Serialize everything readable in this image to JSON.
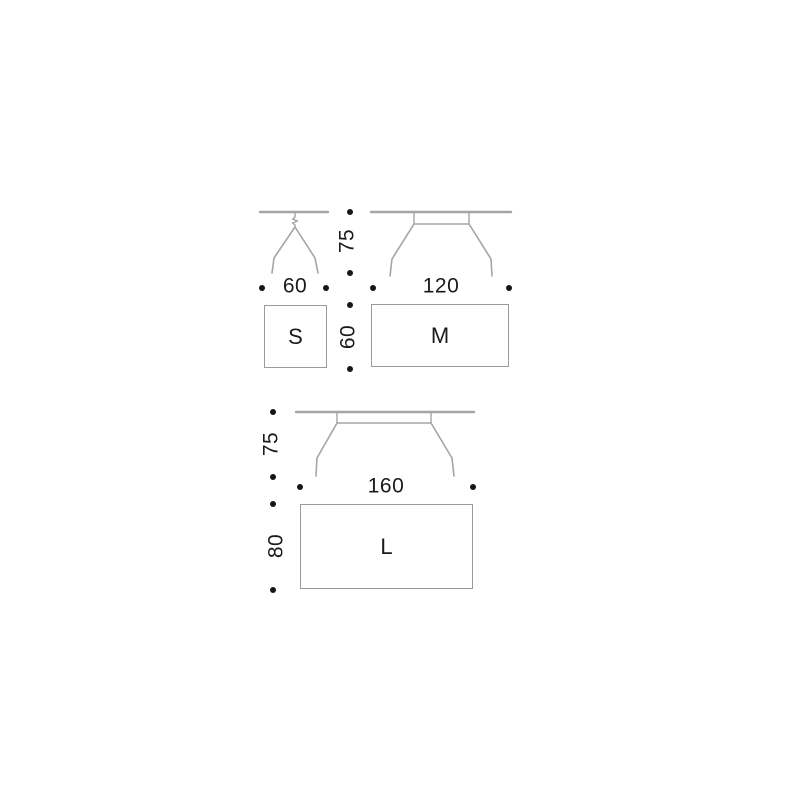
{
  "diagram": {
    "kind": "table-size-dimension-diagram",
    "units_shown": false,
    "colors": {
      "background": "#ffffff",
      "line_art": "#a5a5a5",
      "rect_border": "#9b9b9b",
      "text": "#1a1a1a",
      "dot": "#161616"
    },
    "top_section": {
      "height_label": "75",
      "s_width_label": "60",
      "m_width_label": "120",
      "depth_label": "60",
      "s_label": "S",
      "m_label": "M"
    },
    "bottom_section": {
      "height_label": "75",
      "l_width_label": "160",
      "l_depth_label": "80",
      "l_label": "L"
    },
    "sizes": [
      {
        "size": "S",
        "width": "60",
        "depth": "60",
        "height": "75"
      },
      {
        "size": "M",
        "width": "120",
        "depth": "60",
        "height": "75"
      },
      {
        "size": "L",
        "width": "160",
        "depth": "80",
        "height": "75"
      }
    ]
  }
}
